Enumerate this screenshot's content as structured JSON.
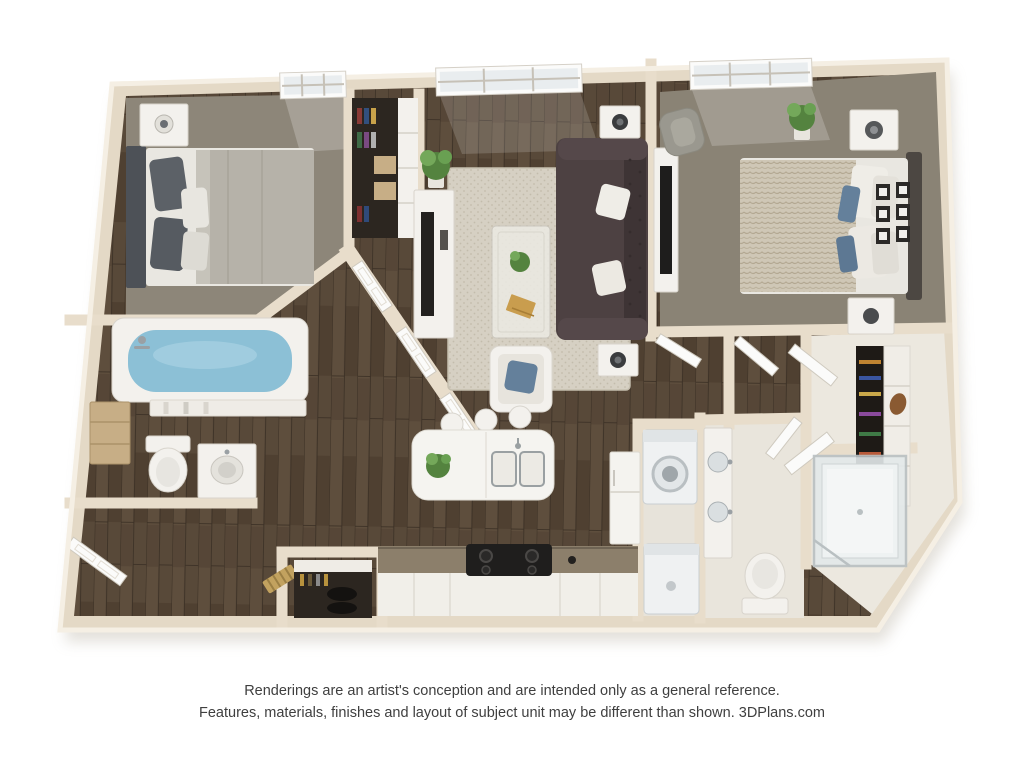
{
  "disclaimer": {
    "line1": "Renderings are an artist's conception and are intended only as a general reference.",
    "line2": "Features, materials, finishes and layout of subject unit may be different than shown. 3DPlans.com"
  },
  "colors": {
    "bg": "#ffffff",
    "text": "#3f3f3f",
    "wall-fill": "#e4d9c6",
    "wall-top": "#f5efe4",
    "wall-edge": "#cfc2ad",
    "wall-part": "#e8ddcb",
    "wood-base": "#584939",
    "wood-dark": "#453829",
    "wood-light": "#6b5945",
    "carpet-1": "#8d8679",
    "carpet-2": "#8a8375",
    "rug": "#d6d0c3",
    "rug-dot": "#c3bcac",
    "sofa": "#4d4142",
    "sofa-dark": "#3e3435",
    "water": "#8cc0d6",
    "plant": "#54833f",
    "plant-light": "#74a85a",
    "blanket-knit": "#cfc7b6",
    "knit-line": "#b3a892",
    "pillow-blue": "#64809b",
    "pillow-dark": "#5c6167",
    "bed-light": "#b6b2a9",
    "mattress": "#e9e7e1",
    "headboard-1": "#4d5157",
    "headboard-2": "#4c4742",
    "fixture-white": "#f3f1ed",
    "fixture-edge": "#d8d4cc",
    "appliance": "#eff1f2",
    "appliance-edge": "#c9ced1",
    "counter": "#8c7f6b",
    "stove": "#1f1e1d",
    "closet-dark": "#2c2620",
    "glass": "#e3e9ea",
    "door-white": "#fbfbfa",
    "tan-wood": "#c7ae86",
    "shoe-gold": "#c2a25f"
  }
}
